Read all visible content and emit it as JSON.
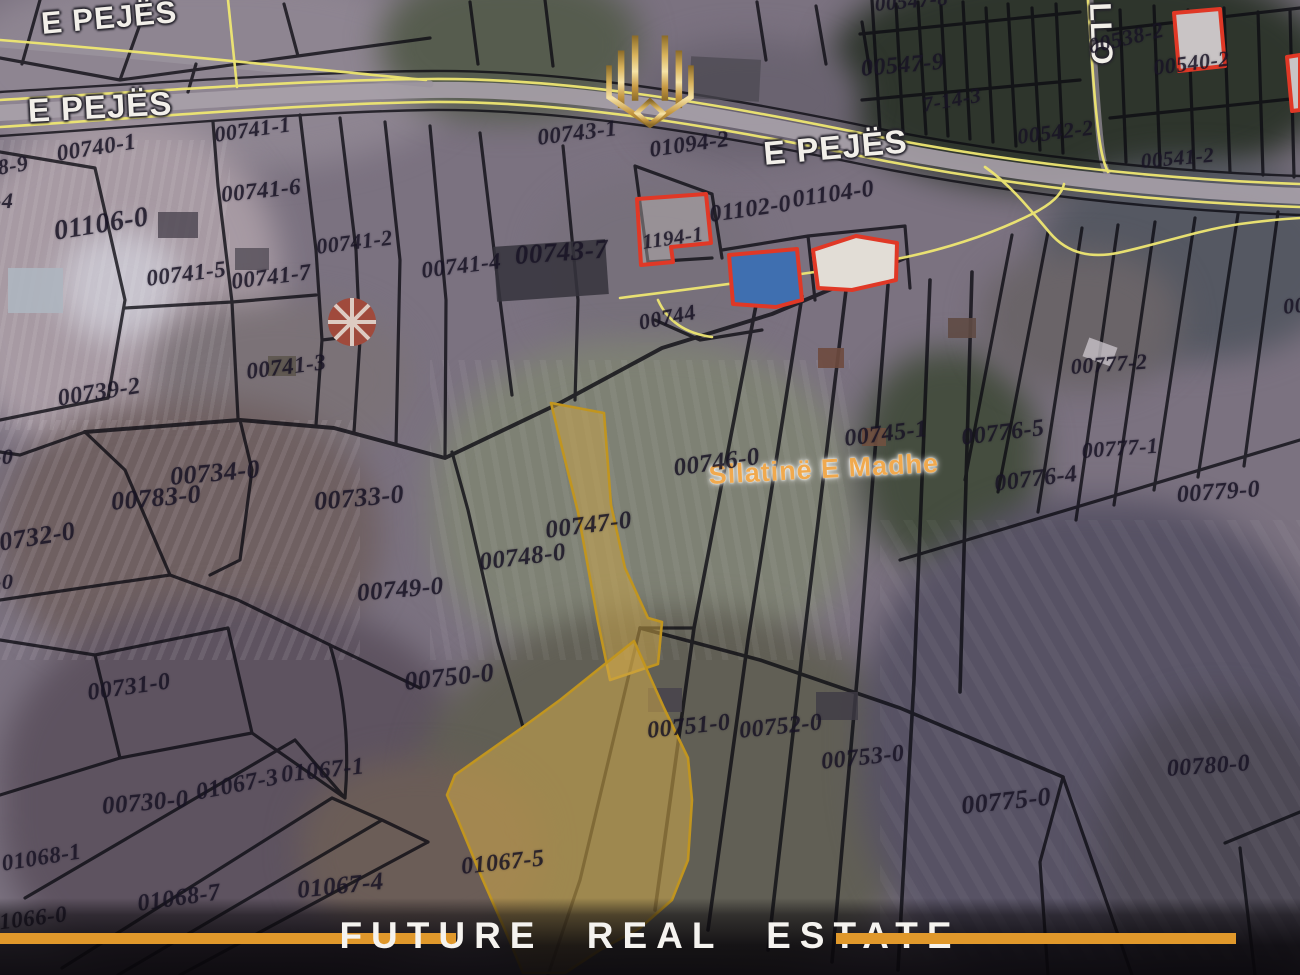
{
  "banner": {
    "title": "FUTURE  REAL  ESTATE",
    "bar_color": "#E0982B",
    "text_color": "#F5F3EF"
  },
  "map": {
    "place_name": "Sllatinë E Madhe",
    "highlighted_parcels": [
      "00747-0",
      "01067-5"
    ],
    "colors": {
      "parcel_line": "#0C0B12",
      "road_line": "#EFE772",
      "building_outline": "#E03826",
      "highlight_fill": "#CDA546",
      "highlight_stroke": "#C1951F"
    },
    "labels": [
      {
        "t": "E PEJËS",
        "x": 40,
        "y": 8,
        "r": -5,
        "s": 31,
        "k": "road"
      },
      {
        "t": "E PEJËS",
        "x": 27,
        "y": 94,
        "r": -3,
        "s": 33,
        "k": "road"
      },
      {
        "t": "E PEJËS",
        "x": 762,
        "y": 137,
        "r": -5,
        "s": 33,
        "k": "road"
      },
      {
        "t": "LLO",
        "x": 1114,
        "y": 2,
        "r": 88,
        "s": 30,
        "k": "road-vert"
      },
      {
        "t": "Sllatinë E Madhe",
        "x": 708,
        "y": 462,
        "r": -3,
        "s": 27,
        "k": "place"
      },
      {
        "t": "00740-1",
        "x": 55,
        "y": 142,
        "r": -9,
        "s": 23,
        "k": "parcel"
      },
      {
        "t": "00741-1",
        "x": 213,
        "y": 124,
        "r": -8,
        "s": 22,
        "k": "parcel"
      },
      {
        "t": "00743-1",
        "x": 536,
        "y": 126,
        "r": -7,
        "s": 23,
        "k": "parcel"
      },
      {
        "t": "01094-2",
        "x": 648,
        "y": 138,
        "r": -8,
        "s": 23,
        "k": "parcel"
      },
      {
        "t": "00547-8",
        "x": 874,
        "y": -6,
        "r": -5,
        "s": 21,
        "k": "parcel"
      },
      {
        "t": "00547-9",
        "x": 860,
        "y": 57,
        "r": -5,
        "s": 24,
        "k": "parcel"
      },
      {
        "t": "7-14-3",
        "x": 921,
        "y": 95,
        "r": -10,
        "s": 21,
        "k": "frag"
      },
      {
        "t": "00542-2",
        "x": 1016,
        "y": 126,
        "r": -7,
        "s": 22,
        "k": "parcel"
      },
      {
        "t": "00538-2",
        "x": 1086,
        "y": 36,
        "r": -13,
        "s": 22,
        "k": "parcel"
      },
      {
        "t": "00540-2",
        "x": 1152,
        "y": 57,
        "r": -7,
        "s": 22,
        "k": "parcel"
      },
      {
        "t": "00541-2",
        "x": 1140,
        "y": 151,
        "r": -5,
        "s": 21,
        "k": "parcel"
      },
      {
        "t": "01106-0",
        "x": 52,
        "y": 218,
        "r": -9,
        "s": 28,
        "k": "parcel"
      },
      {
        "t": "00741-6",
        "x": 220,
        "y": 183,
        "r": -6,
        "s": 23,
        "k": "parcel"
      },
      {
        "t": "00741-2",
        "x": 315,
        "y": 236,
        "r": -7,
        "s": 22,
        "k": "parcel"
      },
      {
        "t": "00741-5",
        "x": 145,
        "y": 267,
        "r": -7,
        "s": 23,
        "k": "parcel"
      },
      {
        "t": "00741-7",
        "x": 230,
        "y": 270,
        "r": -7,
        "s": 23,
        "k": "parcel"
      },
      {
        "t": "00741-4",
        "x": 420,
        "y": 259,
        "r": -7,
        "s": 23,
        "k": "parcel"
      },
      {
        "t": "00743-7",
        "x": 514,
        "y": 242,
        "r": -4,
        "s": 27,
        "k": "parcel"
      },
      {
        "t": "1194-1",
        "x": 641,
        "y": 232,
        "r": -8,
        "s": 21,
        "k": "parcel"
      },
      {
        "t": "01102-0",
        "x": 708,
        "y": 203,
        "r": -8,
        "s": 24,
        "k": "parcel"
      },
      {
        "t": "01104-0",
        "x": 791,
        "y": 188,
        "r": -8,
        "s": 24,
        "k": "parcel"
      },
      {
        "t": "00744",
        "x": 637,
        "y": 312,
        "r": -11,
        "s": 22,
        "k": "parcel"
      },
      {
        "t": "00741-3",
        "x": 245,
        "y": 360,
        "r": -7,
        "s": 23,
        "k": "parcel"
      },
      {
        "t": "00739-2",
        "x": 56,
        "y": 387,
        "r": -9,
        "s": 24,
        "k": "parcel"
      },
      {
        "t": "00734-0",
        "x": 169,
        "y": 464,
        "r": -5,
        "s": 26,
        "k": "parcel"
      },
      {
        "t": "00783-0",
        "x": 110,
        "y": 489,
        "r": -5,
        "s": 26,
        "k": "parcel"
      },
      {
        "t": "00733-0",
        "x": 313,
        "y": 489,
        "r": -5,
        "s": 26,
        "k": "parcel"
      },
      {
        "t": "00732-0",
        "x": -16,
        "y": 532,
        "r": -9,
        "s": 26,
        "k": "parcel"
      },
      {
        "t": "00749-0",
        "x": 356,
        "y": 581,
        "r": -5,
        "s": 25,
        "k": "parcel"
      },
      {
        "t": "00748-0",
        "x": 478,
        "y": 550,
        "r": -7,
        "s": 25,
        "k": "parcel"
      },
      {
        "t": "00747-0",
        "x": 544,
        "y": 518,
        "r": -7,
        "s": 25,
        "k": "parcel"
      },
      {
        "t": "00746-0",
        "x": 672,
        "y": 456,
        "r": -8,
        "s": 25,
        "k": "parcel"
      },
      {
        "t": "00745-1",
        "x": 843,
        "y": 427,
        "r": -7,
        "s": 24,
        "k": "parcel"
      },
      {
        "t": "00776-5",
        "x": 960,
        "y": 426,
        "r": -7,
        "s": 24,
        "k": "parcel"
      },
      {
        "t": "00776-4",
        "x": 993,
        "y": 472,
        "r": -7,
        "s": 24,
        "k": "parcel"
      },
      {
        "t": "00777-2",
        "x": 1070,
        "y": 356,
        "r": -4,
        "s": 22,
        "k": "parcel"
      },
      {
        "t": "00777-1",
        "x": 1081,
        "y": 440,
        "r": -4,
        "s": 22,
        "k": "parcel"
      },
      {
        "t": "00779-0",
        "x": 1176,
        "y": 483,
        "r": -4,
        "s": 24,
        "k": "parcel"
      },
      {
        "t": "00750-0",
        "x": 403,
        "y": 669,
        "r": -6,
        "s": 26,
        "k": "parcel"
      },
      {
        "t": "00751-0",
        "x": 646,
        "y": 719,
        "r": -6,
        "s": 24,
        "k": "parcel"
      },
      {
        "t": "00752-0",
        "x": 738,
        "y": 719,
        "r": -6,
        "s": 24,
        "k": "parcel"
      },
      {
        "t": "00753-0",
        "x": 820,
        "y": 750,
        "r": -6,
        "s": 24,
        "k": "parcel"
      },
      {
        "t": "00775-0",
        "x": 960,
        "y": 793,
        "r": -6,
        "s": 26,
        "k": "parcel"
      },
      {
        "t": "00780-0",
        "x": 1166,
        "y": 757,
        "r": -4,
        "s": 24,
        "k": "parcel"
      },
      {
        "t": "00731-0",
        "x": 86,
        "y": 681,
        "r": -8,
        "s": 24,
        "k": "parcel"
      },
      {
        "t": "01067-1",
        "x": 280,
        "y": 763,
        "r": -6,
        "s": 24,
        "k": "parcel"
      },
      {
        "t": "01067-3",
        "x": 194,
        "y": 781,
        "r": -11,
        "s": 24,
        "k": "parcel"
      },
      {
        "t": "00730-0",
        "x": 101,
        "y": 794,
        "r": -5,
        "s": 25,
        "k": "parcel"
      },
      {
        "t": "01068-1",
        "x": 0,
        "y": 852,
        "r": -9,
        "s": 23,
        "k": "parcel"
      },
      {
        "t": "01068-7",
        "x": 136,
        "y": 892,
        "r": -8,
        "s": 24,
        "k": "parcel"
      },
      {
        "t": "01066-0",
        "x": -14,
        "y": 912,
        "r": -7,
        "s": 23,
        "k": "parcel"
      },
      {
        "t": "01067-4",
        "x": 296,
        "y": 878,
        "r": -6,
        "s": 25,
        "k": "parcel"
      },
      {
        "t": "01067-5",
        "x": 460,
        "y": 855,
        "r": -6,
        "s": 24,
        "k": "parcel"
      },
      {
        "t": "8-9",
        "x": -4,
        "y": 157,
        "r": -9,
        "s": 22,
        "k": "frag"
      },
      {
        "t": "-4",
        "x": -6,
        "y": 190,
        "r": 0,
        "s": 22,
        "k": "frag"
      },
      {
        "t": "-0",
        "x": -6,
        "y": 446,
        "r": 0,
        "s": 22,
        "k": "frag"
      },
      {
        "t": "-0",
        "x": -6,
        "y": 571,
        "r": 0,
        "s": 22,
        "k": "frag"
      },
      {
        "t": "00",
        "x": 1282,
        "y": 296,
        "r": -6,
        "s": 22,
        "k": "frag"
      }
    ]
  }
}
